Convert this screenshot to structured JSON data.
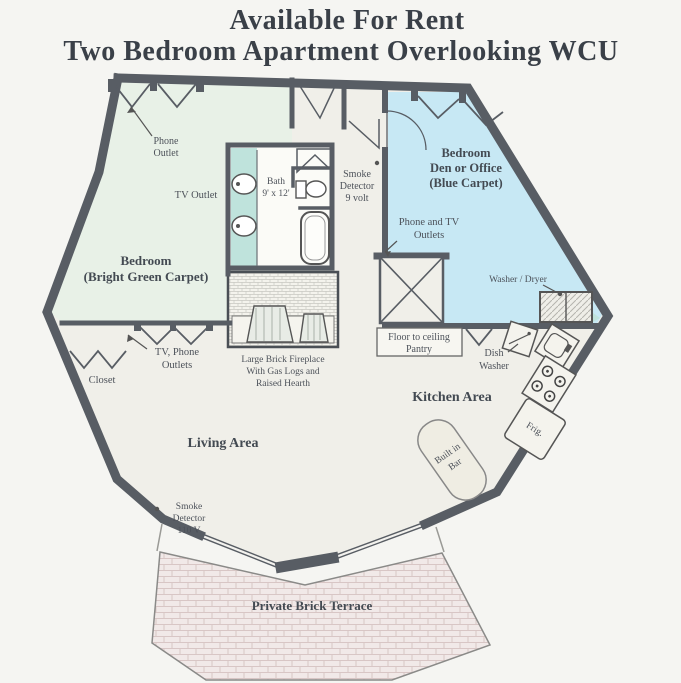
{
  "title": {
    "line1": "Available For Rent",
    "line2": "Two Bedroom Apartment Overlooking WCU"
  },
  "colors": {
    "paper": "#f5f5f2",
    "wall": "#585d64",
    "floor": "#f0efe9",
    "green_carpet": "#e8f1e7",
    "blue_carpet": "#c7e8f4",
    "teal_bath": "#bfe3dc",
    "terrace": "#f1e9e8",
    "label_text": "#4d525a",
    "room_label_text": "#434a52",
    "title_text": "#3a4048"
  },
  "labels": {
    "phone_outlet": {
      "line1": "Phone",
      "line2": "Outlet"
    },
    "tv_outlet": "TV Outlet",
    "bath": {
      "line1": "Bath",
      "line2": "9' x 12'"
    },
    "smoke_detector_entry": {
      "line1": "Smoke",
      "line2": "Detector",
      "line3": "9 volt"
    },
    "bedroom_den": {
      "line1": "Bedroom",
      "line2": "Den or Office",
      "line3": "(Blue Carpet)"
    },
    "phone_tv_outlets": {
      "line1": "Phone and TV",
      "line2": "Outlets"
    },
    "washer_dryer": "Washer / Dryer",
    "bedroom_left": {
      "line1": "Bedroom",
      "line2": "(Bright Green Carpet)"
    },
    "tv_phone_outlets": {
      "line1": "TV, Phone",
      "line2": "Outlets"
    },
    "closet": "Closet",
    "fireplace": {
      "line1": "Large Brick Fireplace",
      "line2": "With Gas Logs and",
      "line3": "Raised Hearth"
    },
    "pantry": {
      "line1": "Floor to ceiling",
      "line2": "Pantry"
    },
    "dish_washer": {
      "line1": "Dish",
      "line2": "Washer"
    },
    "kitchen_area": "Kitchen Area",
    "frig": "Frig.",
    "living_area": "Living Area",
    "built_in_bar": {
      "line1": "Built in",
      "line2": "Bar"
    },
    "smoke_detector_living": {
      "line1": "Smoke",
      "line2": "Detector",
      "line3": "110 V"
    },
    "terrace": "Private Brick Terrace"
  }
}
